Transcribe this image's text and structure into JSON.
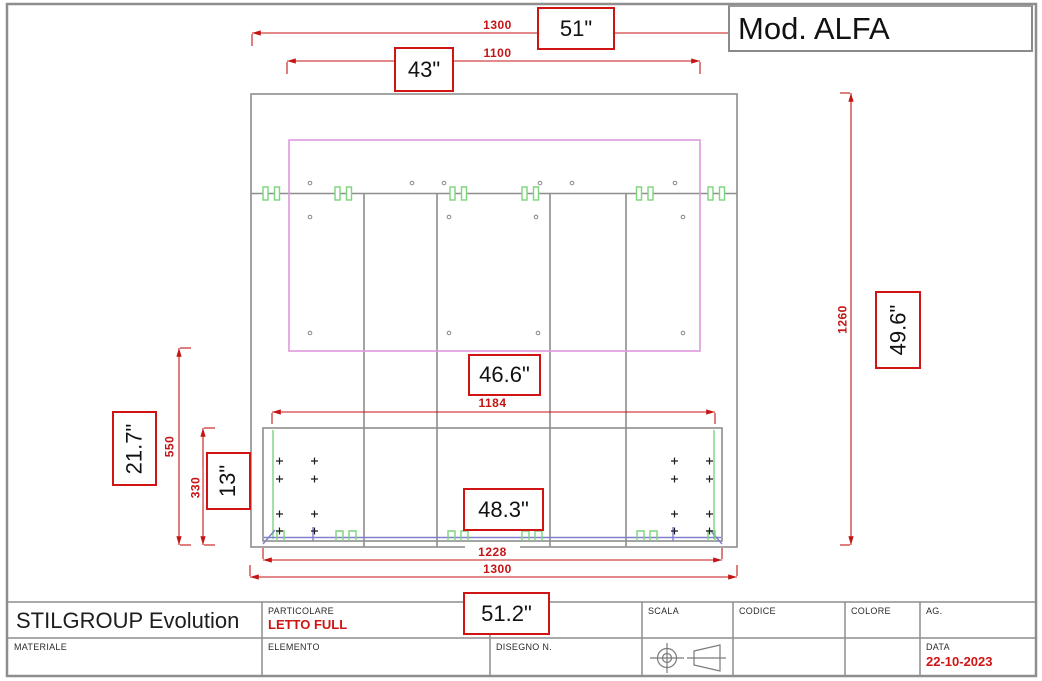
{
  "model": "Mod. ALFA",
  "dimensions": {
    "top_outer": {
      "mm": "1300",
      "inch": "51\""
    },
    "top_inner": {
      "mm": "1100",
      "inch": "43\""
    },
    "height_right": {
      "mm": "1260",
      "inch": "49.6\""
    },
    "left_outer": {
      "mm": "550",
      "inch": "21.7\""
    },
    "left_inner": {
      "mm": "330",
      "inch": "13\""
    },
    "mid_width": {
      "mm": "1184",
      "inch": "46.6\""
    },
    "base_width": {
      "mm": "1228",
      "inch": "48.3\""
    },
    "bottom_outer": {
      "mm": "1300",
      "inch": "51.2\""
    }
  },
  "title_block": {
    "company": "STILGROUP Evolution",
    "particolare_label": "PARTICOLARE",
    "particolare_value": "LETTO FULL",
    "materiale_label": "MATERIALE",
    "elemento_label": "ELEMENTO",
    "disegno_label": "DISEGNO N.",
    "scala_label": "SCALA",
    "codice_label": "CODICE",
    "colore_label": "COLORE",
    "ag_label": "AG.",
    "data_label": "DATA",
    "data_value": "22-10-2023"
  },
  "colors": {
    "dimension_red": "#c41414",
    "line_gray": "#8e8e8e",
    "panel_pink": "#dd9add",
    "fitting_green": "#7cd47c",
    "fitting_blue": "#8080cc"
  }
}
